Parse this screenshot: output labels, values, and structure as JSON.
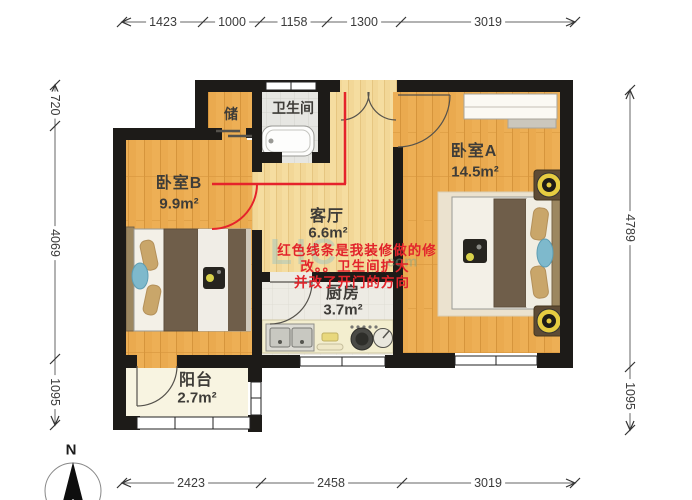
{
  "compass": {
    "label": "N"
  },
  "watermark": {
    "main": "LIC",
    "suffix": ".com"
  },
  "rooms": {
    "bedroom_b": {
      "name": "卧室B",
      "area": "9.9m²"
    },
    "storage": {
      "name": "储"
    },
    "bathroom": {
      "name": "卫生间"
    },
    "living": {
      "name": "客厅",
      "area": "6.6m²"
    },
    "kitchen": {
      "name": "厨房",
      "area": "3.7m²"
    },
    "bedroom_a": {
      "name": "卧室A",
      "area": "14.5m²"
    },
    "balcony": {
      "name": "阳台",
      "area": "2.7m²"
    }
  },
  "annotation": {
    "color": "#e2242b",
    "line1": "红色线条是我装修做的修",
    "line2": "改。。卫生间扩大",
    "line3": "并改了开门的方向"
  },
  "dimensions": {
    "top": [
      "1423",
      "1000",
      "1158",
      "1300",
      "3019"
    ],
    "bottom": [
      "2423",
      "2458",
      "3019"
    ],
    "left": [
      "720",
      "4069",
      "1095"
    ],
    "right": [
      "4789",
      "1095"
    ]
  }
}
